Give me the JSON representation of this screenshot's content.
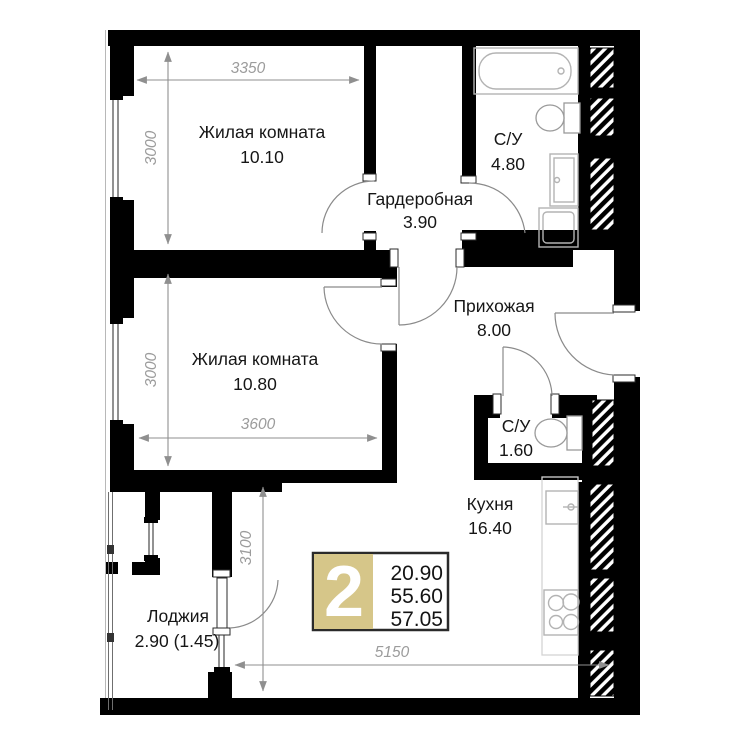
{
  "plan": {
    "rooms": [
      {
        "name": "Жилая комната",
        "area": "10.10"
      },
      {
        "name": "С/У",
        "area": "4.80"
      },
      {
        "name": "Гардеробная",
        "area": "3.90"
      },
      {
        "name": "Прихожая",
        "area": "8.00"
      },
      {
        "name": "Жилая комната",
        "area": "10.80"
      },
      {
        "name": "С/У",
        "area": "1.60"
      },
      {
        "name": "Кухня",
        "area": "16.40"
      },
      {
        "name": "Лоджия",
        "area": "2.90 (1.45)"
      }
    ],
    "dimensions": [
      {
        "value": "3350"
      },
      {
        "value": "3000"
      },
      {
        "value": "3000"
      },
      {
        "value": "3600"
      },
      {
        "value": "3100"
      },
      {
        "value": "5150"
      }
    ],
    "badge": {
      "number": "2",
      "values": [
        "20.90",
        "55.60",
        "57.05"
      ]
    },
    "fixtures": [
      "bathtub",
      "toilet",
      "washbasin",
      "washing-machine",
      "toilet",
      "kitchen-sink",
      "stove"
    ],
    "colors": {
      "wall": "#000000",
      "badge_fill": "#d6c689",
      "badge_border": "#2a2a2a",
      "dimension_text": "#9c9c9c",
      "fixture_stroke": "#b3b3b3"
    }
  }
}
